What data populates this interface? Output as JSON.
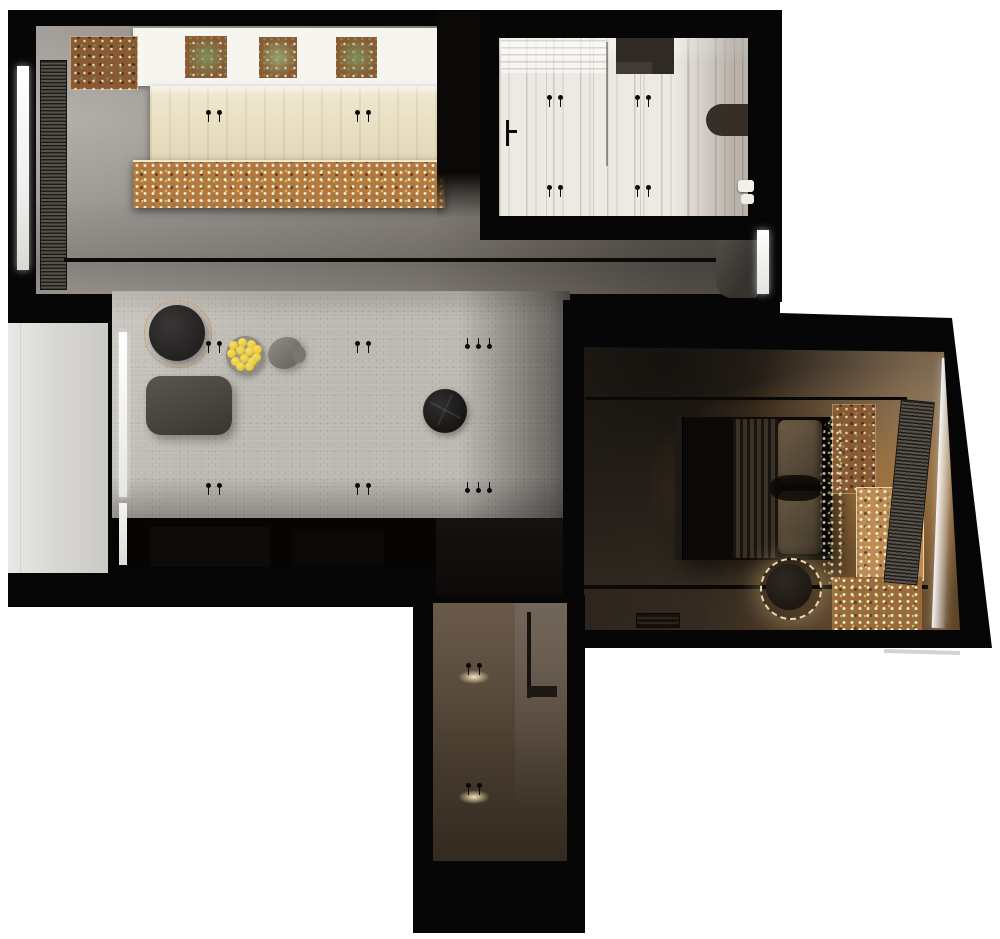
{
  "scene": {
    "description": "Top-down 3D rendered apartment floor plan",
    "background": "#ffffff"
  },
  "palette": {
    "wall": "#070606",
    "pin": "#0b0a09",
    "carpet": "#bcb8b2",
    "balcony": "#d9d8d5",
    "counter": "#f7f5f0",
    "marble": "#edeae4",
    "soil": "#8a5a33",
    "soil_warm": "#b5793f",
    "lemon": "#e8ca3a",
    "ring_gold": "#c9a873",
    "ring_cream": "#e9d8ae",
    "pouf": "#504b46",
    "media": "#060504",
    "window_light": "#ffffff"
  },
  "light_markers": [
    {
      "x": 206,
      "y": 110,
      "count": 2
    },
    {
      "x": 355,
      "y": 110,
      "count": 2
    },
    {
      "x": 547,
      "y": 95,
      "count": 2
    },
    {
      "x": 635,
      "y": 95,
      "count": 2
    },
    {
      "x": 547,
      "y": 185,
      "count": 2
    },
    {
      "x": 635,
      "y": 185,
      "count": 2
    },
    {
      "x": 206,
      "y": 341,
      "count": 2
    },
    {
      "x": 355,
      "y": 341,
      "count": 2
    },
    {
      "x": 465,
      "y": 337,
      "count": 3,
      "flip": true
    },
    {
      "x": 206,
      "y": 483,
      "count": 2
    },
    {
      "x": 355,
      "y": 483,
      "count": 2
    },
    {
      "x": 465,
      "y": 481,
      "count": 3,
      "flip": true
    },
    {
      "x": 466,
      "y": 663,
      "count": 2,
      "glow": true
    },
    {
      "x": 466,
      "y": 783,
      "count": 2,
      "glow": true
    }
  ],
  "lemon_bowl": {
    "count": 13,
    "positions": [
      [
        3,
        5
      ],
      [
        12,
        2
      ],
      [
        21,
        4
      ],
      [
        27,
        9
      ],
      [
        1,
        13
      ],
      [
        10,
        10
      ],
      [
        19,
        11
      ],
      [
        26,
        17
      ],
      [
        5,
        21
      ],
      [
        14,
        18
      ],
      [
        22,
        21
      ],
      [
        10,
        26
      ],
      [
        19,
        26
      ]
    ]
  }
}
